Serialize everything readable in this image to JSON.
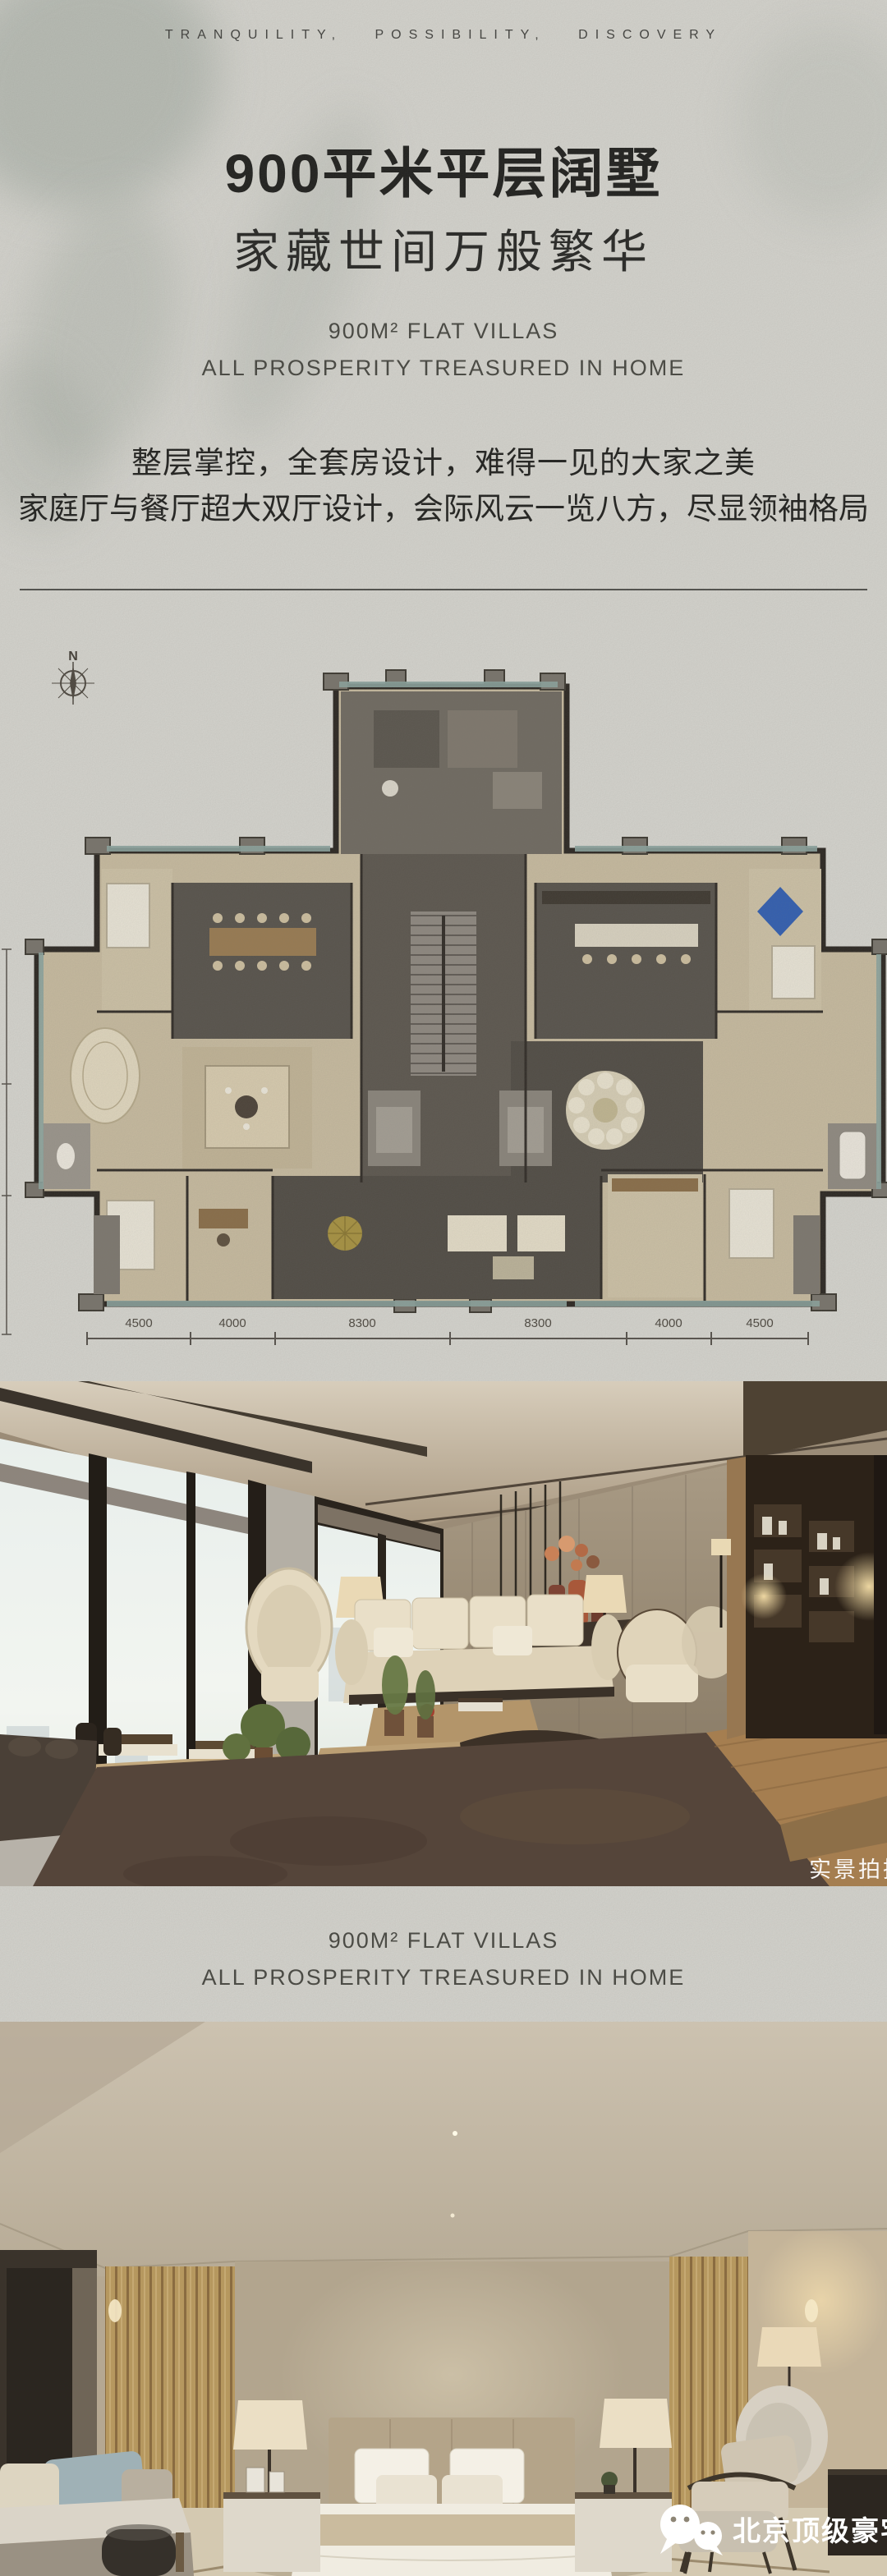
{
  "header": {
    "tagline": "TRANQUILITY,  POSSIBILITY,  DISCOVERY"
  },
  "hero": {
    "title_cn": "900平米平层阔墅",
    "subtitle_cn": "家藏世间万般繁华",
    "en_line1": "900M² FLAT VILLAS",
    "en_line2": "ALL PROSPERITY TREASURED IN HOME",
    "body_line1": "整层掌控，全套房设计，难得一见的大家之美",
    "body_line2": "家庭厅与餐厅超大双厅设计，会际风云一览八方，尽显领袖格局"
  },
  "floorplan": {
    "compass": "N",
    "dims": [
      "4500",
      "4000",
      "8300",
      "8300",
      "4000",
      "4500"
    ]
  },
  "living_photo": {
    "watermark": "实景拍摄"
  },
  "band": {
    "en_line1": "900M² FLAT VILLAS",
    "en_line2": "ALL PROSPERITY TREASURED IN HOME"
  },
  "footer": {
    "brand": "北京顶级豪宅汇"
  },
  "colors": {
    "paper": "#d8d7d1",
    "ink": "#1c1c1a",
    "muted": "#45453f",
    "plan_wall": "#29241f",
    "plan_floor": "#c9bca0",
    "plan_blue_rug": "#2f5db2",
    "watermark_white": "#ffffff"
  }
}
